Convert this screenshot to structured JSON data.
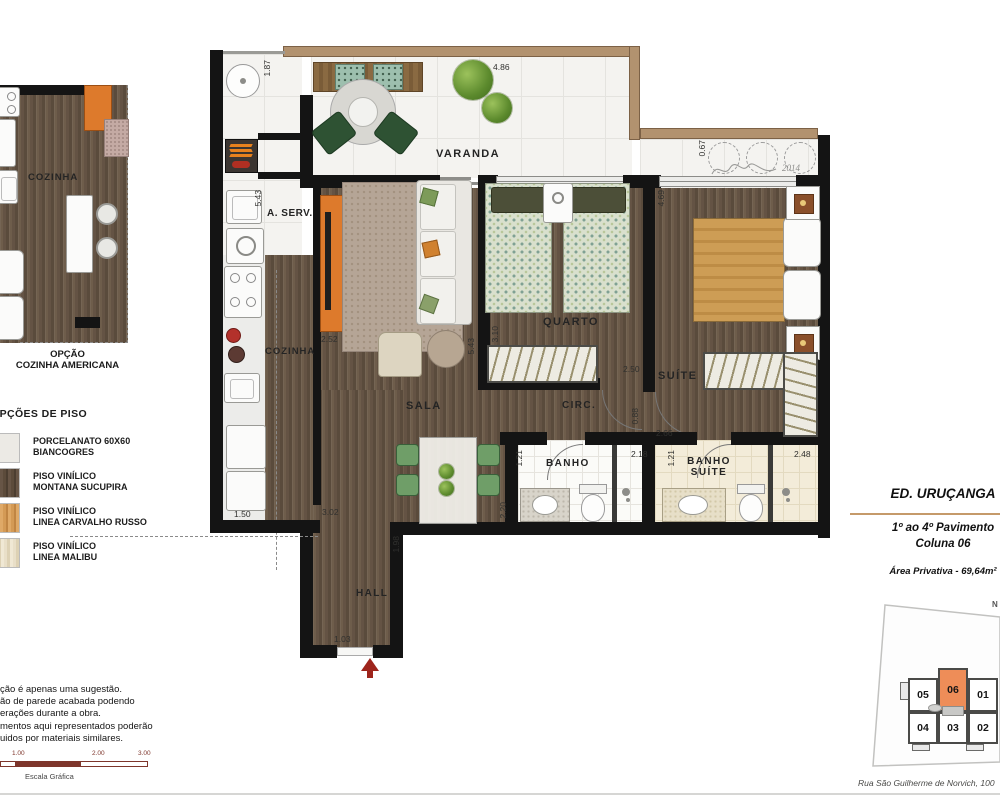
{
  "plan": {
    "rooms": {
      "varanda": "VARANDA",
      "servico": "A. SERV.",
      "cozinha": "COZINHA",
      "sala": "SALA",
      "quarto": "QUARTO",
      "circulacao": "CIRC.",
      "suite": "SUÍTE",
      "banho": "BANHO",
      "banho_suite_line1": "BANHO",
      "banho_suite_line2": "SUÍTE",
      "hall": "HALL"
    },
    "dimensions": [
      "1.87",
      "4.86",
      "5.43",
      "0.67",
      "4.69",
      "2.52",
      "5.43",
      "3.10",
      "2.50",
      "2.66",
      "0.88",
      "1.50",
      "3.02",
      "1.98",
      "2.20",
      "1.21",
      "2.18",
      "1.21",
      "2.48",
      "1.03"
    ],
    "signature_year": "2014"
  },
  "inset": {
    "room": "COZINHA",
    "caption_line1": "OPÇÃO",
    "caption_line2": "COZINHA AMERICANA"
  },
  "floor_legend": {
    "title": "OPÇÕES DE PISO",
    "items": [
      {
        "line1": "PORCELANATO 60X60",
        "line2": "BIANCOGRES"
      },
      {
        "line1": "PISO VINÍLICO",
        "line2": "MONTANA SUCUPIRA"
      },
      {
        "line1": "PISO VINÍLICO",
        "line2": "LINEA CARVALHO RUSSO"
      },
      {
        "line1": "PISO VINÍLICO",
        "line2": "LINEA MALIBU"
      }
    ]
  },
  "disclaimer": {
    "lines": [
      "ção é apenas uma sugestão.",
      "ão de parede acabada podendo",
      "erações durante a obra.",
      "mentos aqui representados poderão",
      "uidos por materiais similares."
    ]
  },
  "scale_bar": {
    "labels": [
      "1.00",
      "2.00",
      "3.00"
    ],
    "caption": "Escala Gráfica"
  },
  "title_block": {
    "building": "ED. URUÇANGA",
    "floors": "1º ao 4º Pavimento",
    "column": "Coluna 06",
    "area": "Área Privativa - 69,64m²",
    "accent_color": "#c59a6a"
  },
  "key_plan": {
    "north": "N",
    "units": [
      "05",
      "06",
      "01",
      "04",
      "03",
      "02"
    ],
    "highlighted_unit": "06",
    "highlight_color": "#ee8d58",
    "address": "Rua São Guilherme de Norvich, 100"
  }
}
